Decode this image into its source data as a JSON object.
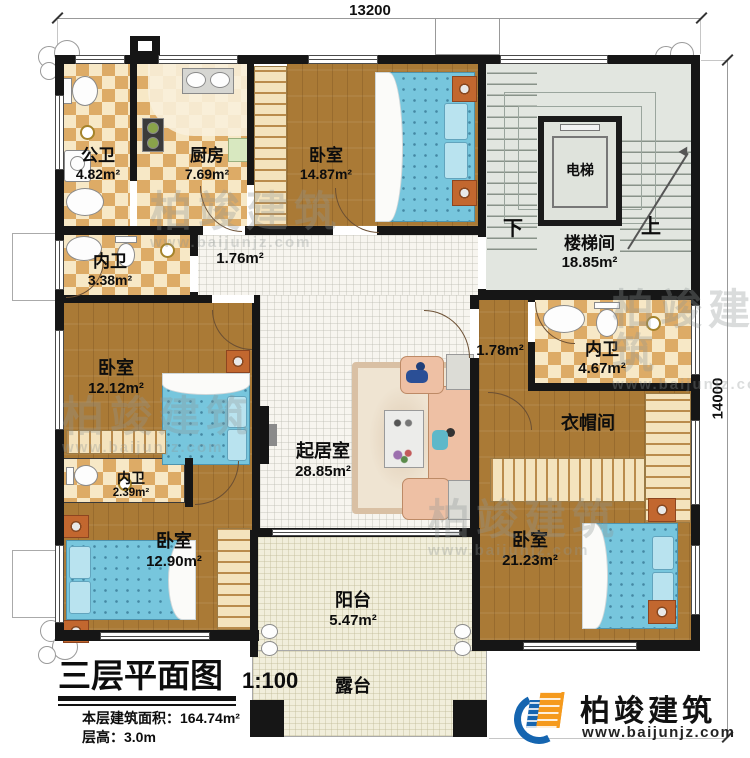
{
  "plan": {
    "dim_top": "13200",
    "dim_right": "14000",
    "rooms": {
      "public_bath": {
        "name": "公卫",
        "area": "4.82m²"
      },
      "kitchen": {
        "name": "厨房",
        "area": "7.69m²"
      },
      "bedroom_top": {
        "name": "卧室",
        "area": "14.87m²"
      },
      "stairwell": {
        "name": "楼梯间",
        "area": "18.85m²",
        "down": "下",
        "up": "上"
      },
      "elevator": {
        "name": "电梯"
      },
      "bath_left": {
        "name": "内卫",
        "area": "3.38m²"
      },
      "hallway": {
        "area": "1.76m²"
      },
      "bedroom_left": {
        "name": "卧室",
        "area": "12.12m²"
      },
      "living": {
        "name": "起居室",
        "area": "28.85m²"
      },
      "corridor": {
        "area": "1.78m²"
      },
      "bath_right": {
        "name": "内卫",
        "area": "4.67m²"
      },
      "cloakroom": {
        "name": "衣帽间"
      },
      "bath_bottom": {
        "name": "内卫",
        "area": "2.39m²"
      },
      "bedroom_bottom_left": {
        "name": "卧室",
        "area": "12.90m²"
      },
      "bedroom_bottom_right": {
        "name": "卧室",
        "area": "21.23m²"
      },
      "balcony": {
        "name": "阳台",
        "area": "5.47m²"
      },
      "terrace": {
        "name": "露台"
      }
    }
  },
  "title_block": {
    "title": "三层平面图",
    "scale": "1:100",
    "floor_area": "本层建筑面积：164.74m²",
    "floor_height": "层高：3.0m"
  },
  "logo": {
    "company": "柏竣建筑",
    "website": "www.baijunjz.com"
  },
  "watermark": {
    "text": "柏竣建筑",
    "url": "www.baijunjz.com"
  }
}
